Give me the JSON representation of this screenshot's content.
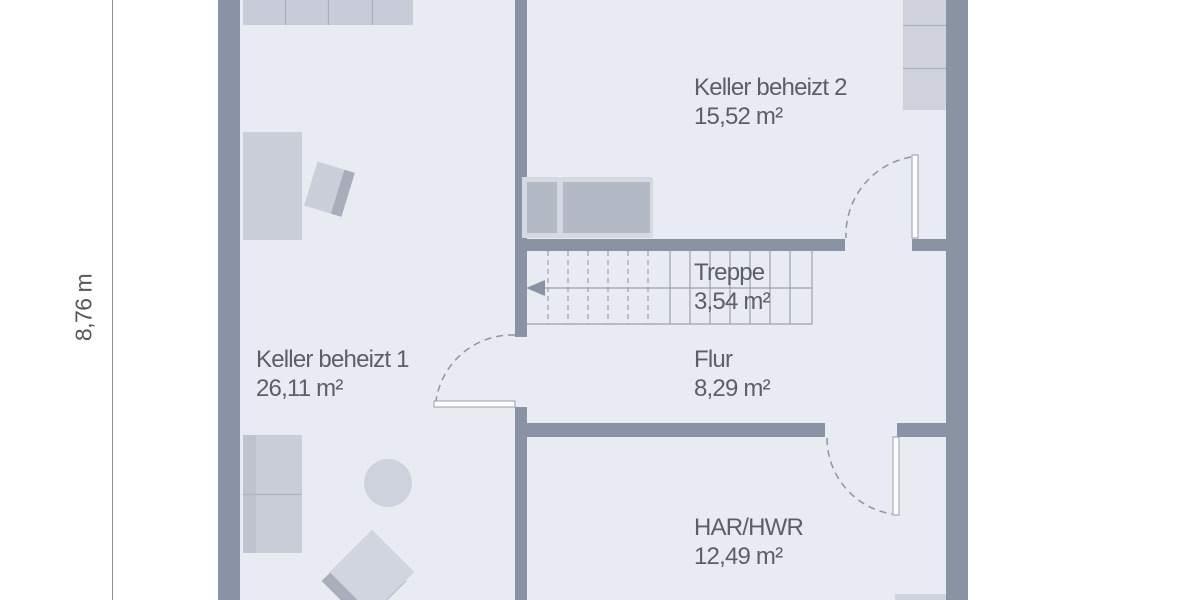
{
  "dimension": {
    "label": "8,76 m"
  },
  "rooms": [
    {
      "id": "keller-beheizt-2",
      "name": "Keller beheizt 2",
      "area": "15,52 m²"
    },
    {
      "id": "treppe",
      "name": "Treppe",
      "area": "3,54 m²"
    },
    {
      "id": "flur",
      "name": "Flur",
      "area": "8,29 m²"
    },
    {
      "id": "keller-beheizt-1",
      "name": "Keller beheizt 1",
      "area": "26,11 m²"
    },
    {
      "id": "har-hwr",
      "name": "HAR/HWR",
      "area": "12,49 m²"
    }
  ],
  "colors": {
    "wall": "#8a93a3",
    "floor": "#e9ebf2",
    "stair_line": "#9aa1ad",
    "door_arc": "#8f959f",
    "furniture_light": "#cbcfda",
    "furniture_medium": "#c9cdd8",
    "furniture_dark": "#b4b9c6",
    "furniture_accent": "#a7adbb",
    "text": "#5b5f66",
    "dimension_line": "#909399"
  }
}
